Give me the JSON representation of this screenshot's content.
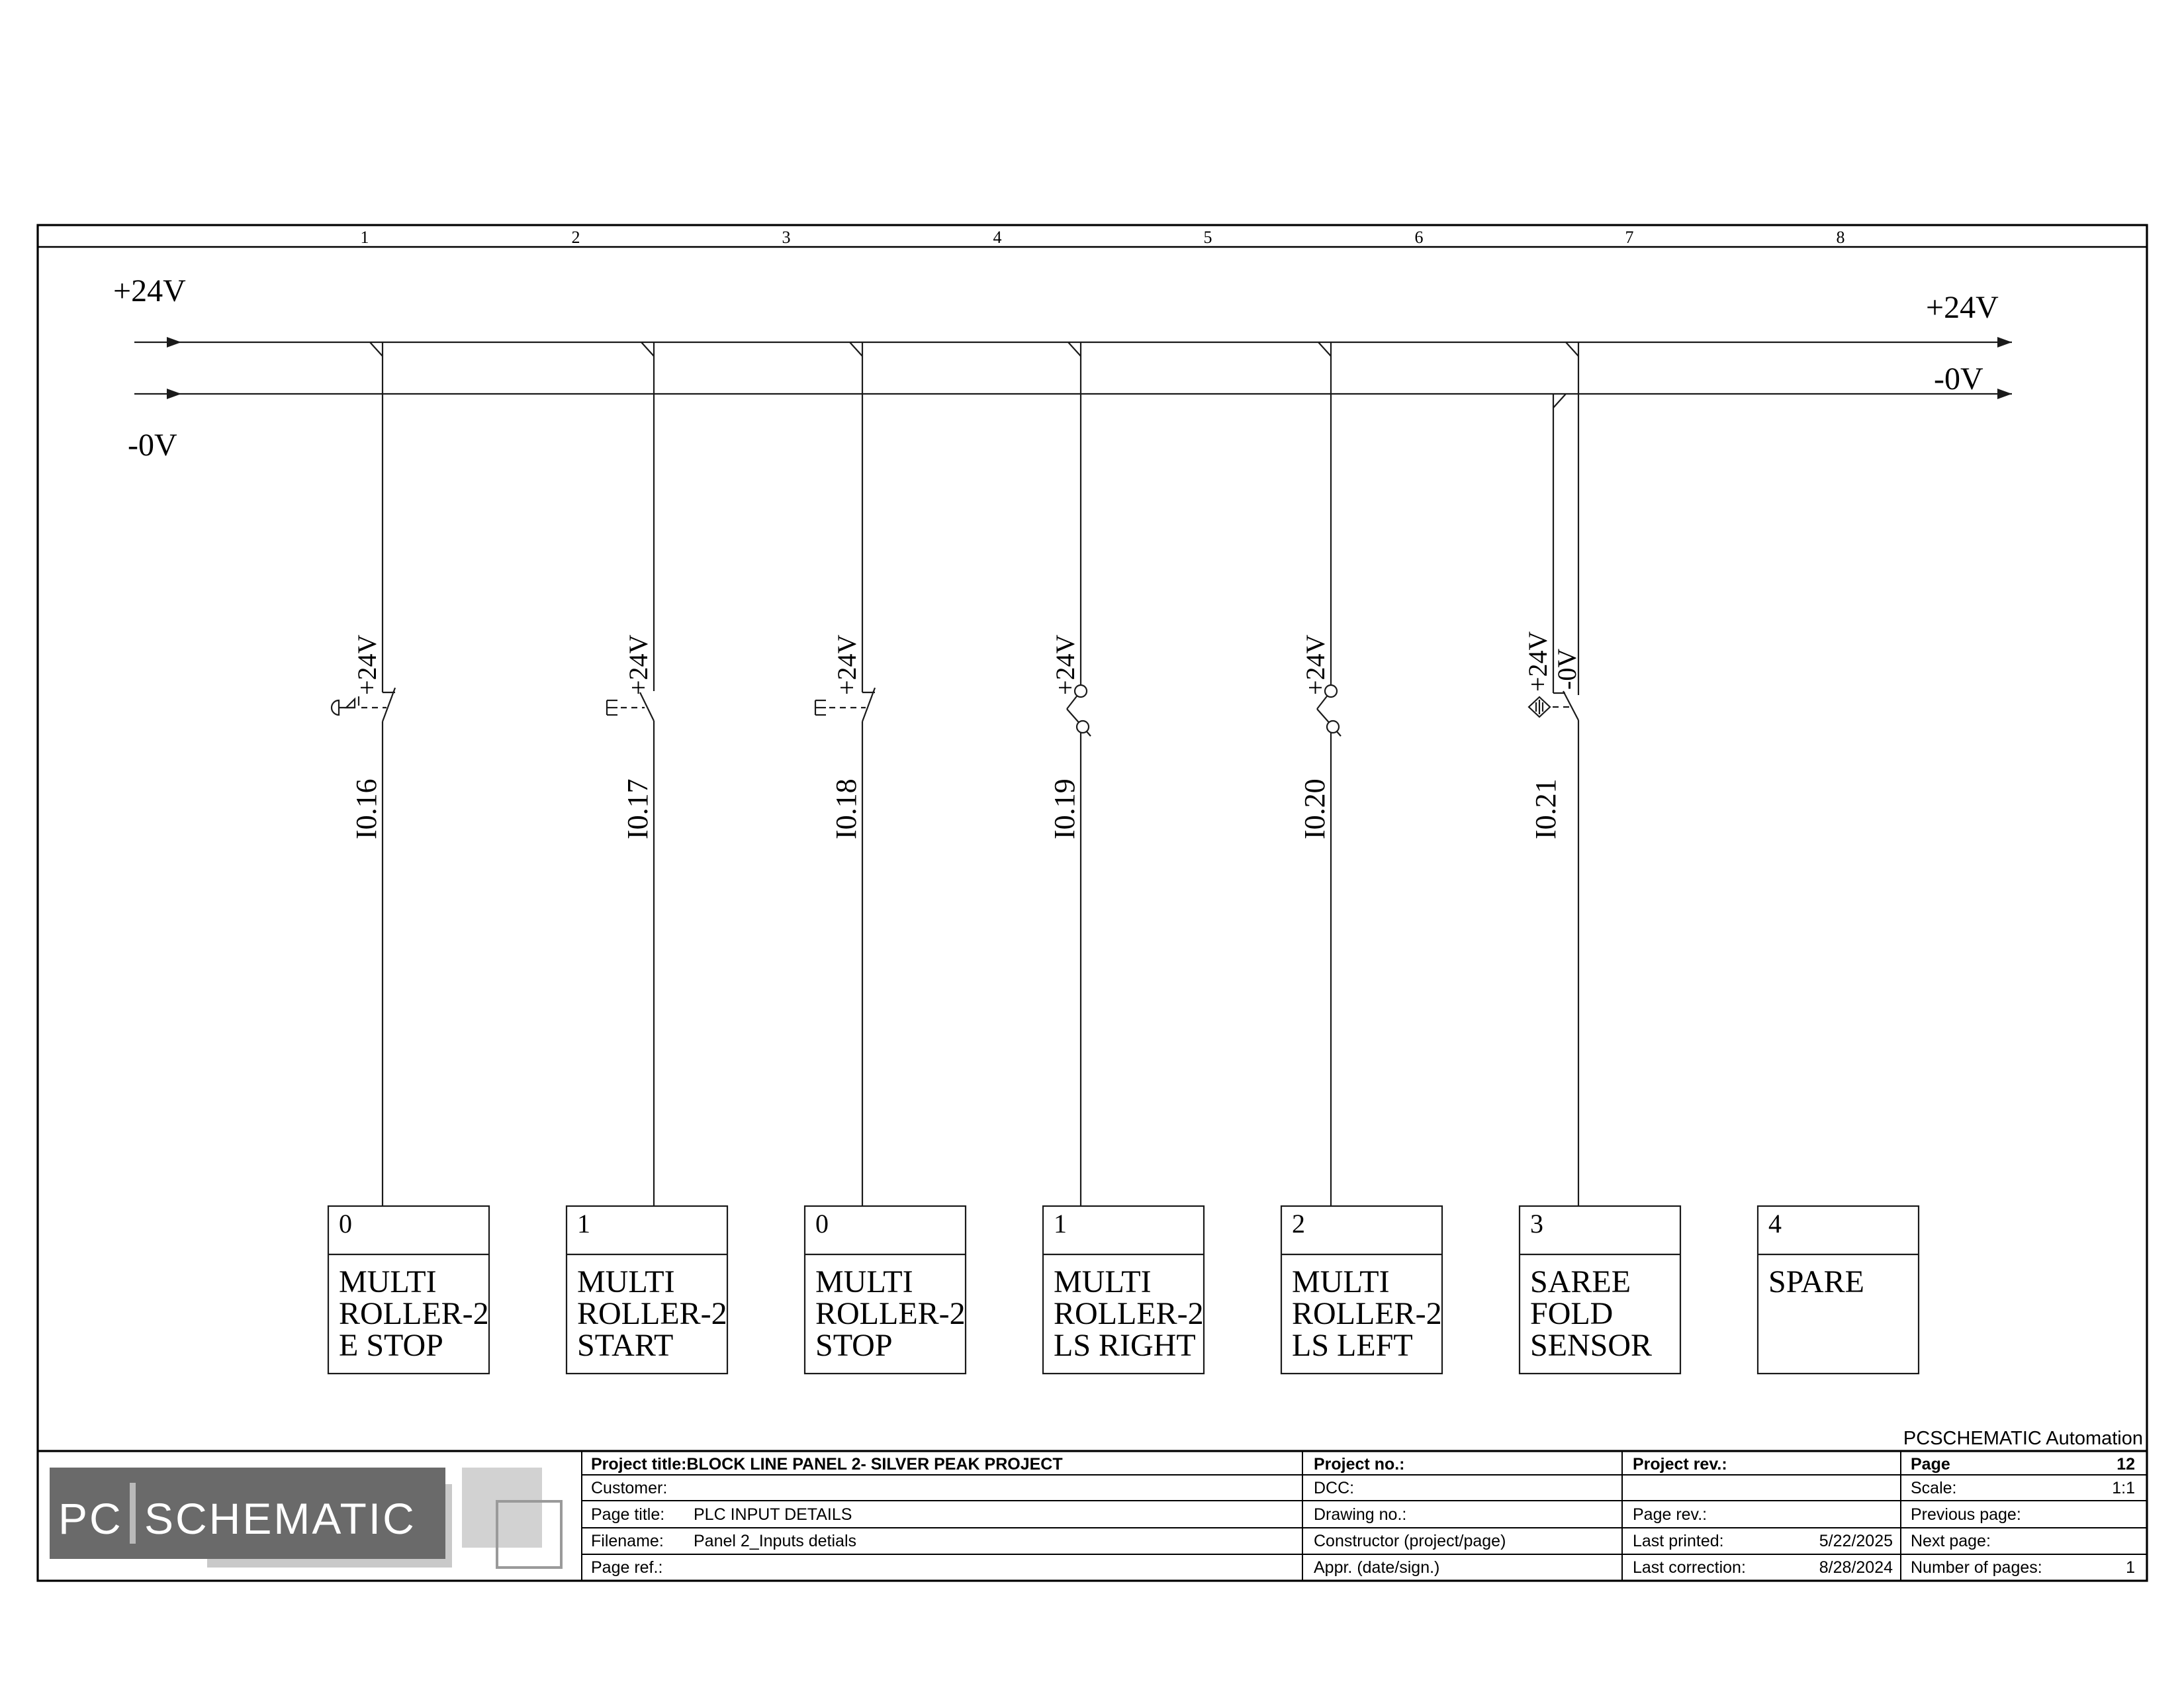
{
  "frame": {
    "columns": [
      "1",
      "2",
      "3",
      "4",
      "5",
      "6",
      "7",
      "8"
    ]
  },
  "rails": {
    "plus_label": "+24V",
    "minus_label": "-0V"
  },
  "branches": [
    {
      "address": "I0.16",
      "supply": "+24V",
      "symbol": "emergency-stop-nc-contact"
    },
    {
      "address": "I0.17",
      "supply": "+24V",
      "symbol": "pushbutton-no-contact"
    },
    {
      "address": "I0.18",
      "supply": "+24V",
      "symbol": "pushbutton-nc-contact"
    },
    {
      "address": "I0.19",
      "supply": "+24V",
      "symbol": "limit-switch-contact"
    },
    {
      "address": "I0.20",
      "supply": "+24V",
      "symbol": "limit-switch-contact"
    },
    {
      "address": "I0.21",
      "supply": "+24V",
      "supply2": "-0V",
      "symbol": "proximity-sensor-contact"
    }
  ],
  "plc_inputs": [
    {
      "number": "0",
      "lines": [
        "MULTI",
        "ROLLER-2",
        "E STOP"
      ]
    },
    {
      "number": "1",
      "lines": [
        "MULTI",
        "ROLLER-2",
        "START"
      ]
    },
    {
      "number": "0",
      "lines": [
        "MULTI",
        "ROLLER-2",
        "STOP"
      ]
    },
    {
      "number": "1",
      "lines": [
        "MULTI",
        "ROLLER-2",
        "LS RIGHT"
      ]
    },
    {
      "number": "2",
      "lines": [
        "MULTI",
        "ROLLER-2",
        "LS LEFT"
      ]
    },
    {
      "number": "3",
      "lines": [
        "SAREE",
        "FOLD",
        "SENSOR"
      ]
    },
    {
      "number": "4",
      "lines": [
        "SPARE",
        "",
        ""
      ]
    }
  ],
  "title_block": {
    "project_title_label": "Project title:",
    "project_title": "BLOCK LINE PANEL 2- SILVER PEAK PROJECT",
    "customer_label": "Customer:",
    "page_title_label": "Page title:",
    "page_title": "PLC INPUT DETAILS",
    "filename_label": "Filename:",
    "filename": "Panel 2_Inputs detials",
    "page_ref_label": "Page ref.:",
    "project_no_label": "Project no.:",
    "dcc_label": "DCC:",
    "drawing_no_label": "Drawing no.:",
    "constructor_label": "Constructor (project/page)",
    "appr_label": "Appr. (date/sign.)",
    "project_rev_label": "Project rev.:",
    "page_rev_label": "Page rev.:",
    "last_printed_label": "Last printed:",
    "last_printed": "5/22/2025",
    "last_correction_label": "Last correction:",
    "last_correction": "8/28/2024",
    "page_label": "Page",
    "page_number": "12",
    "scale_label": "Scale:",
    "scale": "1:1",
    "previous_page_label": "Previous page:",
    "next_page_label": "Next page:",
    "number_of_pages_label": "Number of pages:",
    "number_of_pages": "1"
  },
  "branding": {
    "logo_pc": "PC",
    "logo_schematic": "SCHEMATIC",
    "automation": "PCSCHEMATIC Automation"
  },
  "colors": {
    "line": "#1a1a1a",
    "logo_dark": "#6a6a6a",
    "logo_shadow": "#c9c9c9",
    "logo_square": "#d2d2d2",
    "logo_bar": "#b9b9b9"
  }
}
